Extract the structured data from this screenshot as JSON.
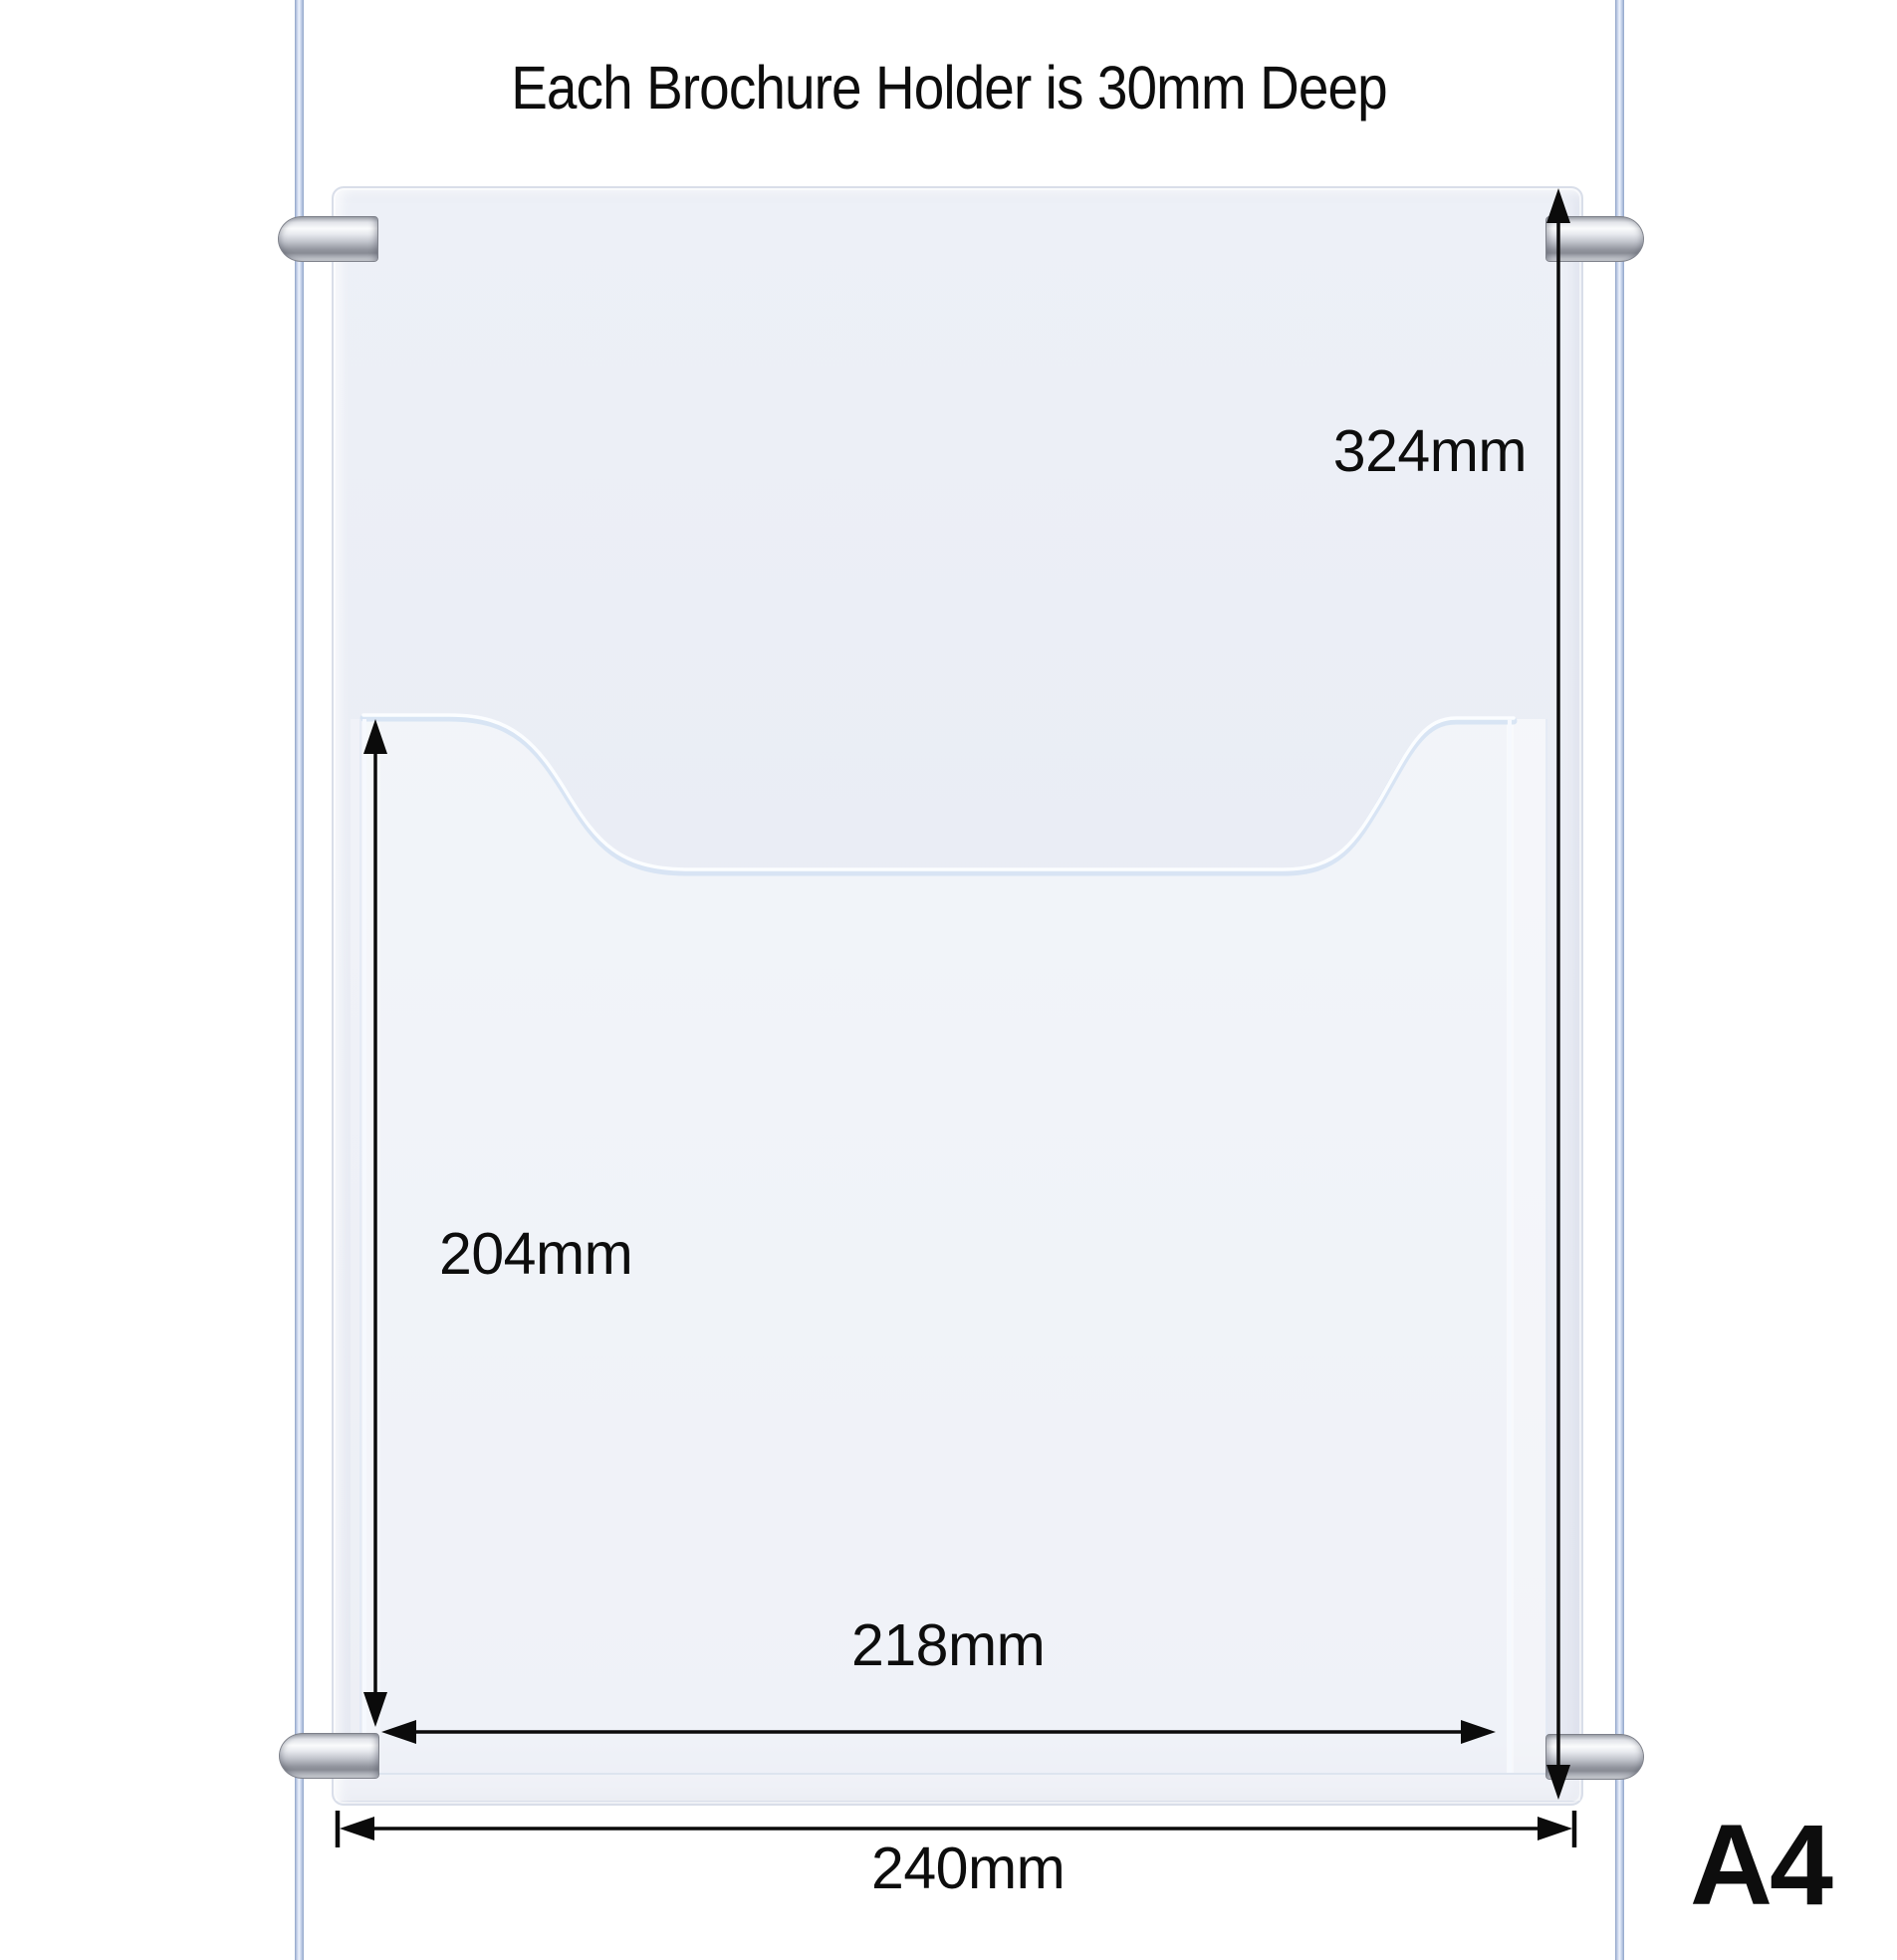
{
  "title": "Each Brochure Holder is 30mm Deep",
  "size_label": "A4",
  "dimensions": {
    "overall_height": "324mm",
    "pocket_height": "204mm",
    "pocket_width": "218mm",
    "overall_width": "240mm"
  },
  "colors": {
    "dimension_line": "#0b0b0b",
    "text": "#0d0d0d",
    "panel_fill": "#e9ecf4",
    "panel_border": "#d9dee9",
    "pocket_highlight": "#fbfdff",
    "clamp_silver": "#c2c5cd",
    "cable_blue": "#8ea2c6",
    "background": "#ffffff"
  }
}
